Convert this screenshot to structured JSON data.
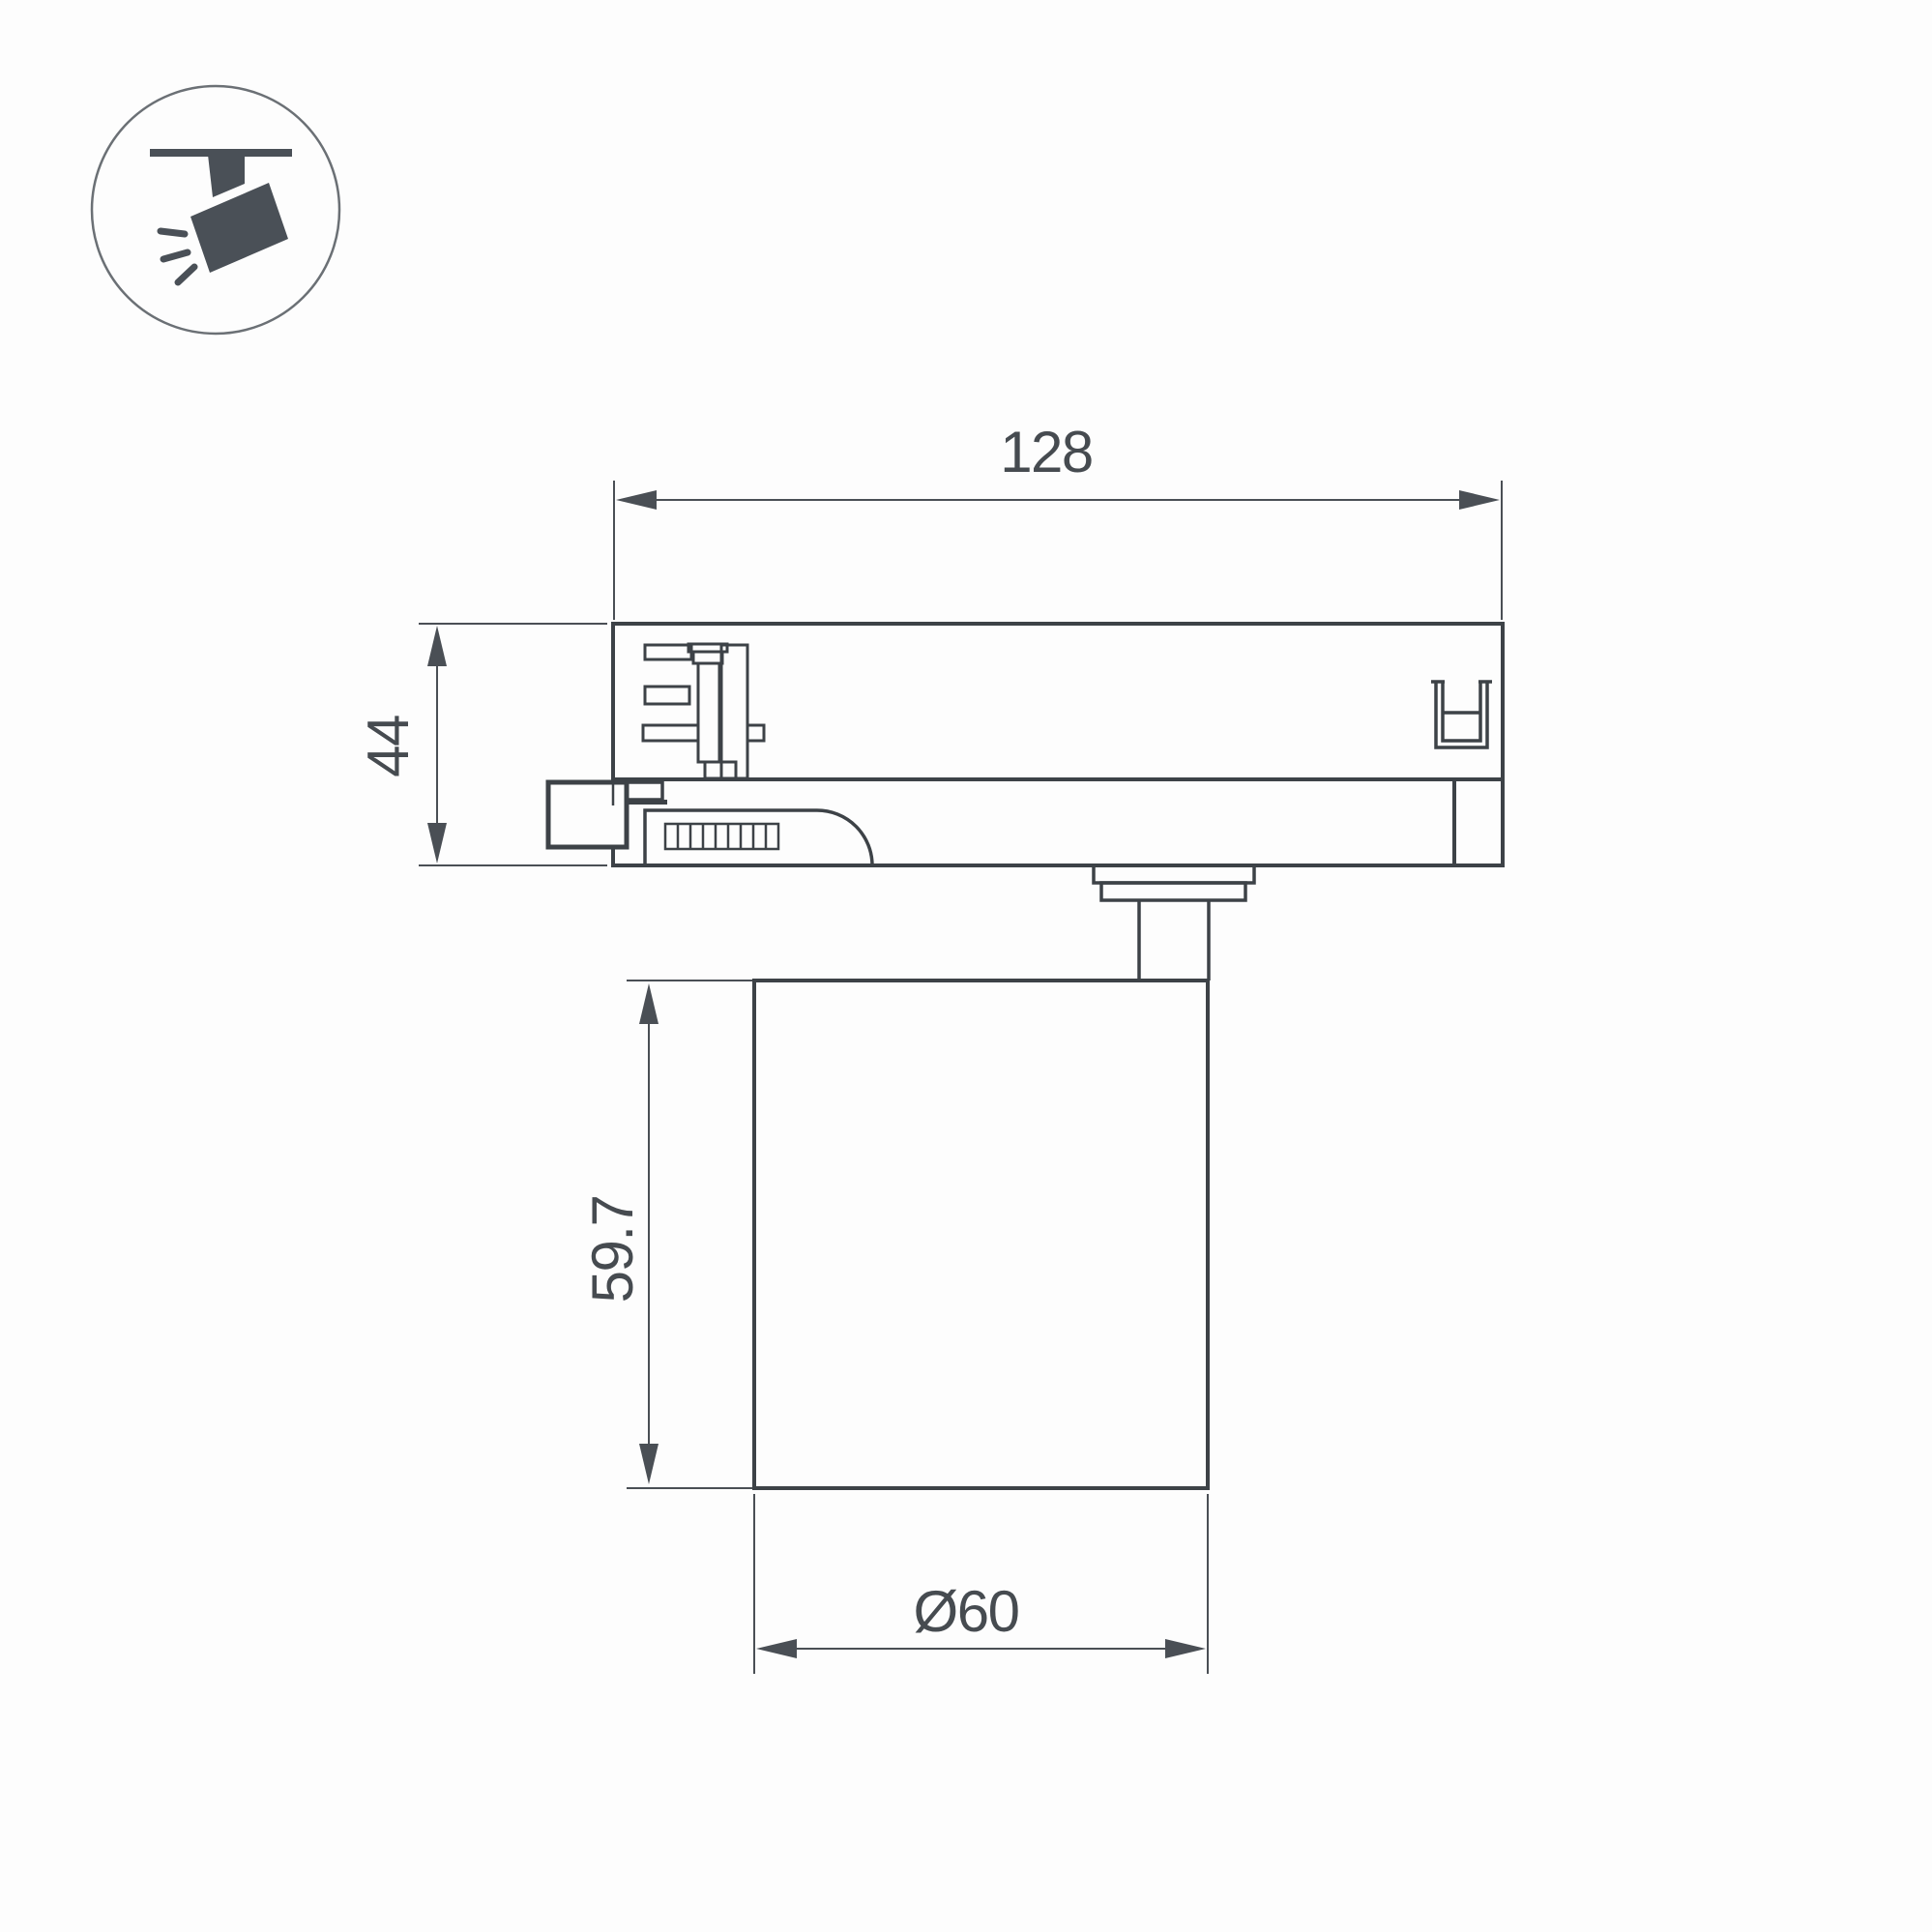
{
  "page": {
    "background": "#fdfdfd"
  },
  "icon": {
    "name": "track-spotlight-icon"
  },
  "drawing": {
    "dimensions": {
      "adapter_width": "128",
      "adapter_height": "44",
      "body_height": "59.7",
      "body_diameter": "Ø60"
    },
    "colors": {
      "outline": "#3d4247",
      "dimension": "#4a4f55",
      "icon_fill": "#4a5057"
    }
  }
}
